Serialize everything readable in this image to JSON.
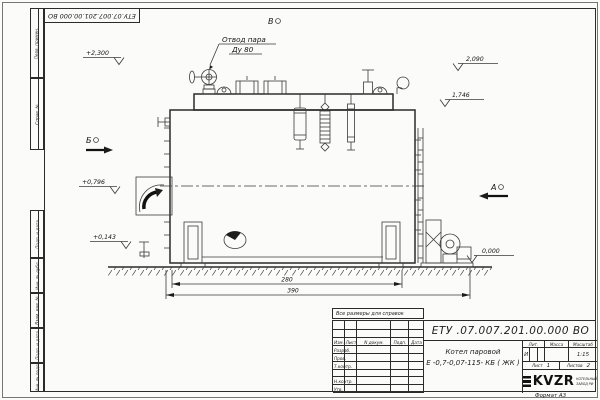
{
  "frame": {
    "top_designation": "ЕТУ.07.007.201.00.000 ВО",
    "left_top_labels": {
      "perv": "Перв. примен.",
      "sprav": "Справ. №"
    },
    "left_bottom_labels": {
      "podp1": "Подп. и дата",
      "inv_dubl": "Инв. № дубл.",
      "vzam": "Взам. инв. №",
      "podp2": "Подп. и дата",
      "inv_podl": "Инв. № подл."
    },
    "format_note": "Формат А3"
  },
  "annotations": {
    "note": "Все размеры для справок",
    "steam_outlet_line1": "Отвод пара",
    "steam_outlet_line2": "Ду 80",
    "view_top": "В",
    "view_left": "Б",
    "view_right": "А",
    "elev_plus_2300": "+2,300",
    "elev_2090": "2,090",
    "elev_1746": "1,746",
    "elev_plus_0796": "+0,796",
    "elev_plus_0143": "+0,143",
    "elev_0000": "0,000",
    "dim_inner": "280",
    "dim_outer": "390"
  },
  "title_block": {
    "designation": "ЕТУ .07.007.201.00.000  ВО",
    "product_name": "Котел паровой",
    "product_code": "Е -0,7-0,07-115- КБ ( ЖК )",
    "col_izm": "Изм.",
    "col_list": "Лист",
    "col_ndoc": "N докум.",
    "col_podp": "Подп.",
    "col_data": "Дата",
    "row_razrab": "Разраб.",
    "row_prov": "Пров.",
    "row_tkontr": "Т.контр.",
    "row_nkontr": "Н.контр.",
    "row_utv": "Утв.",
    "lit_label": "Лит.",
    "mass_label": "Масса",
    "scale_label": "Масштаб",
    "lit_value": "И",
    "scale_value": "1:15",
    "sheet_label": "Лист",
    "sheet_value": "1",
    "sheets_label": "Листов",
    "sheets_value": "2",
    "logo_text": "KVZR",
    "logo_sub1": "КОТЕЛЬНЫЙ",
    "logo_sub2": "ЗАВОД РФ"
  }
}
